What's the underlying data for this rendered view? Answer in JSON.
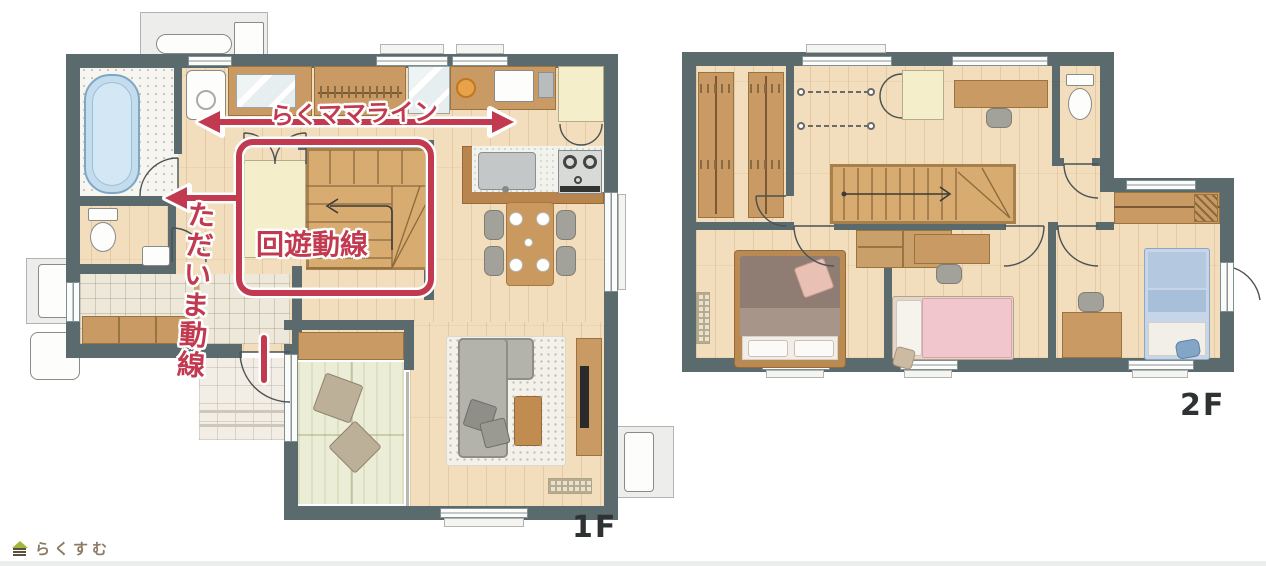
{
  "annotations": {
    "raku_mama_label": "らくママライン",
    "kaiyu_label": "回遊動線",
    "tadaima_label": "ただいま動線"
  },
  "floors": {
    "first_label": "1F",
    "second_label": "2F"
  },
  "logo": {
    "text": "らくすむ"
  },
  "palette": {
    "wall": "#5a6a6d",
    "wood": "#f2ddbd",
    "tile": "#eee8da",
    "tatami": "#ecedd6",
    "cabinet": "#c99a63",
    "cream": "#f4eecb",
    "stair": "#d8ab70",
    "tub_blue": "#c3dcee",
    "bed_pink": "#f2c6cd",
    "bed_blue": "#c6d6e8",
    "accent_red": "#c23a50"
  }
}
